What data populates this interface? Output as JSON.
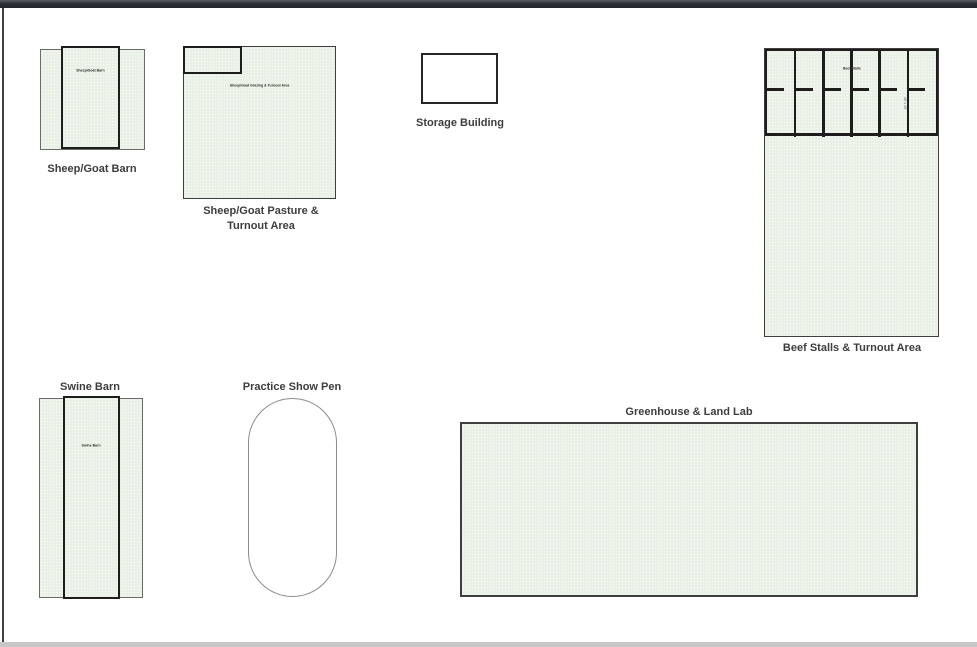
{
  "page": {
    "background": "#ffffff",
    "top_edge_color": "#23272b",
    "left_edge_color": "#3c4247",
    "bottom_edge_color": "#c7c7c7"
  },
  "palette": {
    "area_fill": "#e9f0e5",
    "outline_dark": "#1d1d1d",
    "outline_medium": "#3f3f3f",
    "outline_light": "#6b6b6b",
    "label_text": "#3d3d3d"
  },
  "buildings": {
    "sheep_goat_barn": {
      "label": "Sheep/Goat Barn",
      "inner_label": "Sheep/Goat Barn"
    },
    "sheep_goat_pasture": {
      "label_line1": "Sheep/Goat Pasture &",
      "label_line2": "Turnout Area",
      "inner_label": "Sheep/Goat Grazing & Turnout Area"
    },
    "storage_building": {
      "label": "Storage Building"
    },
    "beef_stalls": {
      "label": "Beef Stalls & Turnout Area",
      "inner_label": "Beef Stalls",
      "dimension_label": "10' x 20'",
      "stall_count": 6
    },
    "swine_barn": {
      "label": "Swine Barn",
      "inner_label": "Swine Barn"
    },
    "practice_show_pen": {
      "label": "Practice Show Pen"
    },
    "greenhouse_land_lab": {
      "label": "Greenhouse & Land Lab"
    }
  }
}
